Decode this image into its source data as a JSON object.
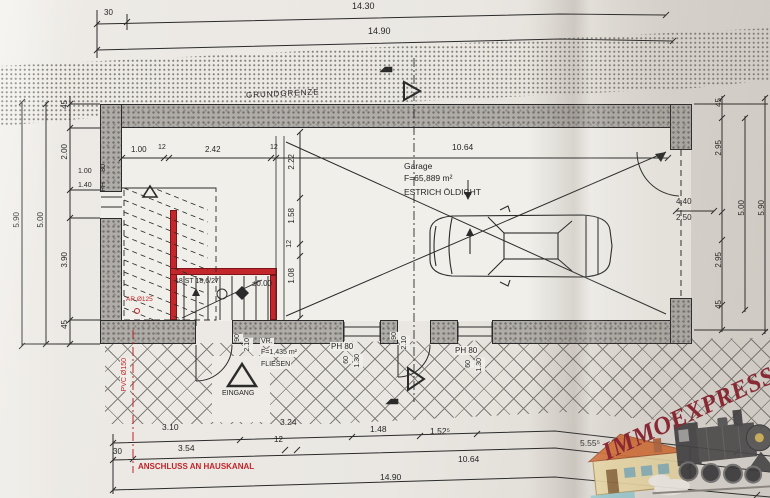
{
  "colors": {
    "ink": "#2b2b2b",
    "wall_red": "#c3272b",
    "annotation_red": "#c2242a",
    "wall_gray": "#b0ada9",
    "paper": "#ece9e4",
    "watermark_red": "#8b2331",
    "hatch_line": "#56534f"
  },
  "watermark": {
    "text": "IMMOEXPRESS",
    "train_icon": "steam-locomotive",
    "house_icon": "house"
  },
  "top": {
    "d30": "30",
    "total_upper": "14.30",
    "total_lower": "14.90",
    "grundgrenze": "GRUNDGRENZE"
  },
  "top_inner": [
    "1.00",
    "12",
    "2.42",
    "12"
  ],
  "garage": {
    "name": "Garage",
    "area": "F=65,889 m²",
    "floor": "ESTRICH ÖLDICHT",
    "width": "10.64"
  },
  "vchain": [
    "2.22",
    "1.58",
    "12",
    "1.08"
  ],
  "left": {
    "t45": "45",
    "d200": "2.00",
    "d100": "1.00",
    "d140": "1.40",
    "ph": "PH",
    "p80": "80",
    "d390": "3.90",
    "b45": "45",
    "d500": "5.00",
    "d590": "5.90"
  },
  "right": {
    "t45": "45",
    "t295": "2.95",
    "d440": "4.40",
    "d250": "2.50",
    "d500": "5.00",
    "d590": "5.90",
    "b295": "2.95",
    "b45": "45"
  },
  "stairs": {
    "steps": "18 ST 18,6/27",
    "level": "±0.00",
    "ar": "AR Ø125"
  },
  "vr": {
    "name": "VR.",
    "area": "F=1,435 m²",
    "floor": "FLIESEN"
  },
  "entrance": {
    "label": "EINGANG"
  },
  "door": {
    "w": "90",
    "h": "2.10"
  },
  "window": {
    "label": "PH 80",
    "w": "60",
    "h": "1.30"
  },
  "bottom": {
    "rowA": [
      "3.10",
      "3.24",
      "1.48",
      "1.52⁵",
      "5.55⁵"
    ],
    "rowB": [
      "30",
      "3.54",
      "12",
      "10.64"
    ],
    "total": "14.90",
    "kanal": "ANSCHLUSS AN HAUSKANAL",
    "pvc": "PVC Ø150"
  }
}
